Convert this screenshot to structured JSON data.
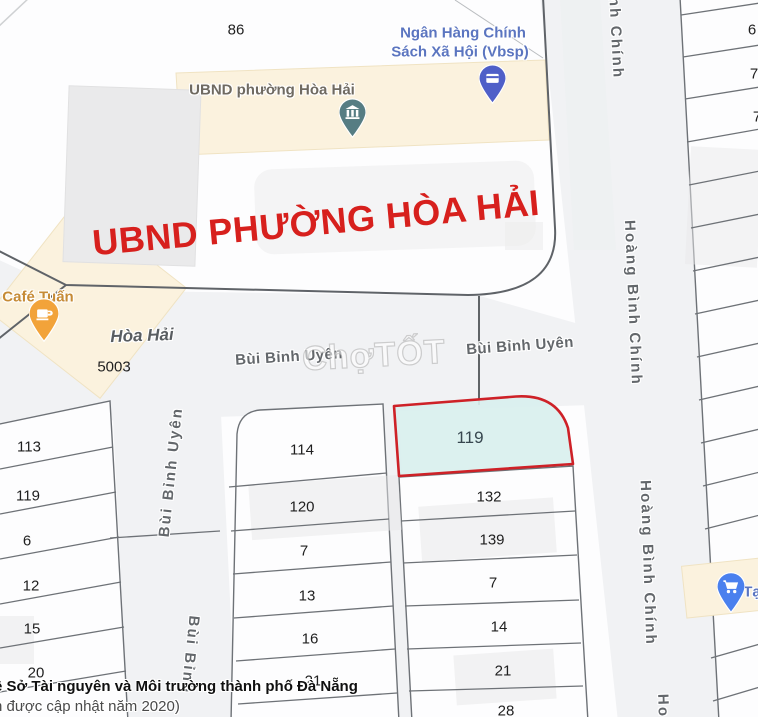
{
  "attribution": {
    "line1": "ề Sở Tài nguyên và Môi trường thành phố Đà Nẵng",
    "line2": "h được cập nhật năm 2020)"
  },
  "watermark": "ChợTỐT",
  "overlay_label": "UBND PHƯỜNG HÒA HẢI",
  "locality": {
    "name": "Hòa Hải",
    "code": "5003"
  },
  "streets": {
    "h1": "Bùi Bỉnh Uyên",
    "h2": "Bùi Bỉnh Uyên",
    "v1": "Bùi Bỉnh Uyên",
    "v2": "Bùi Bỉnh",
    "east_a": "nh Chính",
    "east_b": "Hoàng Bình Chính",
    "east_c": "Hoàng Bình Chính",
    "east_d": "Ho"
  },
  "pois": {
    "bank": {
      "line1": "Ngân Hàng Chính",
      "line2": "Sách Xã Hội (Vbsp)",
      "icon": "bank-card-icon"
    },
    "ubnd": {
      "name": "UBND phường Hòa Hải",
      "icon": "government-building-icon"
    },
    "cafe": {
      "name": "Café Tuấn",
      "icon": "coffee-cup-icon"
    },
    "store": {
      "name": "Tạ",
      "icon": "shopping-cart-icon"
    }
  },
  "parcels": {
    "highlight": "119",
    "top": "86",
    "left": [
      "113",
      "119",
      "6",
      "12",
      "15",
      "20"
    ],
    "middle": [
      "114",
      "120",
      "7",
      "13",
      "16",
      "21"
    ],
    "right": [
      "132",
      "139",
      "7",
      "14",
      "21",
      "28"
    ],
    "east": [
      "6",
      "7",
      "7"
    ]
  },
  "colors": {
    "highlight_fill": "#d9f0ee",
    "highlight_border": "#ce2127",
    "overlay_text": "#d7201d",
    "poi_blue": "#5b75c0",
    "poi_amber": "#c68b36",
    "marker_teal": "#567d83",
    "marker_indigo": "#4f5fc8",
    "marker_amber": "#f2a33a",
    "marker_blue": "#4a80ee",
    "road_casing": "#5f6368",
    "building_fill": "#fbf2de"
  }
}
